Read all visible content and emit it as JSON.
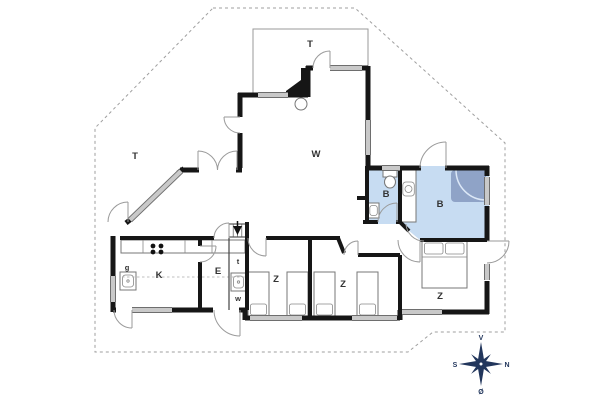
{
  "floorplan": {
    "room_labels": {
      "terrace_top": "T",
      "terrace_left": "T",
      "living_room": "W",
      "bathroom_small": "B",
      "bathroom_large": "B",
      "kitchen": "K",
      "entry": "E",
      "guest_wc": "g",
      "toilet_nook": "t",
      "utility_nook": "w",
      "bedroom_left": "Z",
      "bedroom_middle": "Z",
      "bedroom_right": "Z"
    },
    "compass": {
      "top": "V",
      "left": "S",
      "right": "N",
      "bottom": "Ø"
    },
    "colors": {
      "wall": "#161616",
      "window": "#c9c9c9",
      "window_frame": "#6e6e6e",
      "door_arc": "#9a9a9a",
      "bathroom_fill": "#c7dcf2",
      "shower_fill": "#8fa3c7",
      "shower_arc": "#dce8f7",
      "boundary": "#9f9f9f",
      "terrace_line": "#9a9a9a",
      "compass": "#22365c"
    }
  }
}
